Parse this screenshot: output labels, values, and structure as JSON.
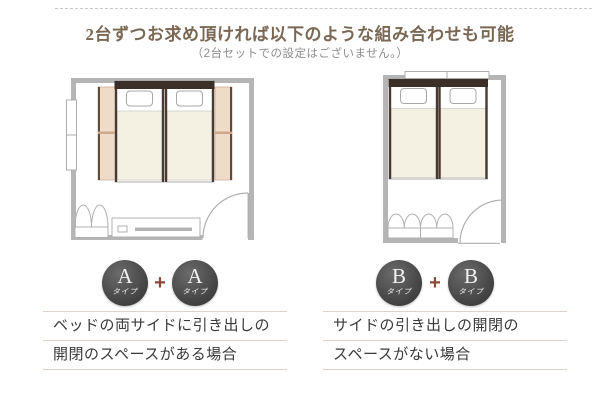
{
  "header": {
    "title": "2台ずつお求め頂ければ以下のような組み合わせも可能",
    "subtitle": "（2台セットでの設定はございません。）"
  },
  "panels": [
    {
      "type_letter": "A",
      "type_suffix": "タイプ",
      "plus_sign": "+",
      "caption_line1": "ベッドの両サイドに引き出しの",
      "caption_line2": "開閉のスペースがある場合",
      "floorplan_note": "twin beds centered, drawer-opening space on both sides"
    },
    {
      "type_letter": "B",
      "type_suffix": "タイプ",
      "plus_sign": "+",
      "caption_line1": "サイドの引き出しの開閉の",
      "caption_line2": "スペースがない場合",
      "floorplan_note": "twin beds flush to wall, no side drawer space"
    }
  ],
  "colors": {
    "title_brown": "#7a6854",
    "subtitle_gray": "#8d8d8d",
    "wall_gray": "#b5b5b5",
    "mattress_ivory": "#f4f1e3",
    "headboard_brown": "#3c2f27",
    "drawer_beige": "#eedbc8",
    "drawer_edge": "#5f4a3c",
    "badge_gray": "#4a4a4a",
    "plus_brown": "#8a4a36",
    "rule_tan": "#ddd2c5"
  }
}
